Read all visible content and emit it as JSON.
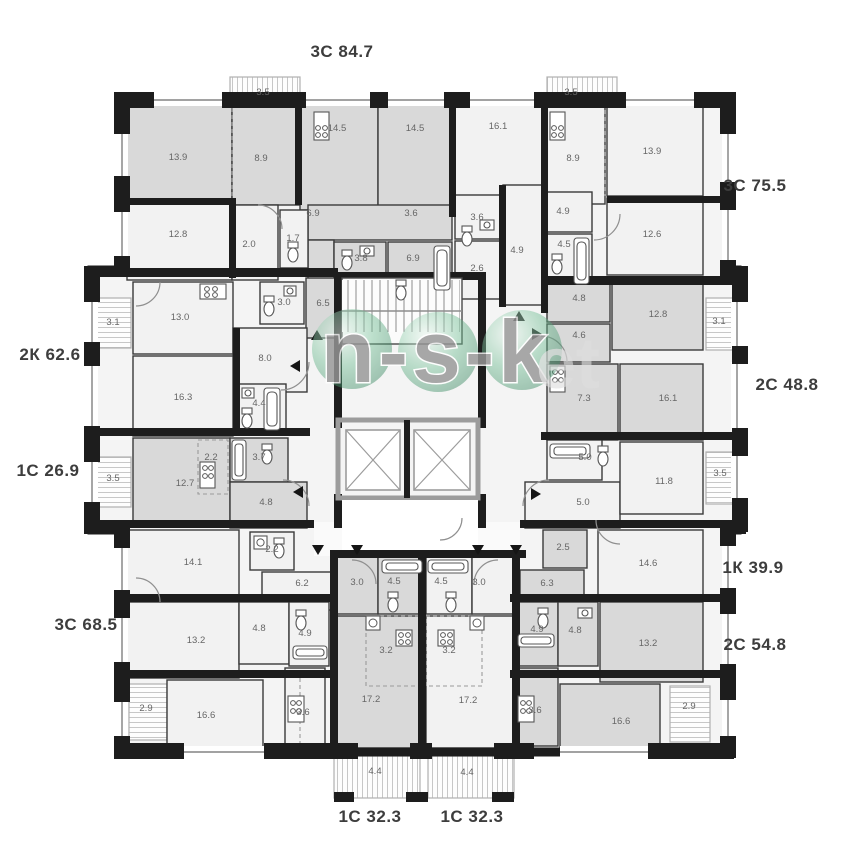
{
  "watermark": {
    "text": "n-s-k",
    "suffix": "et"
  },
  "apartment_labels": [
    {
      "label": "3С 84.7"
    },
    {
      "label": "3С 75.5"
    },
    {
      "label": "2С 48.8"
    },
    {
      "label": "1К 39.9"
    },
    {
      "label": "2С 54.8"
    },
    {
      "label": "1С 32.3"
    },
    {
      "label": "1С 32.3"
    },
    {
      "label": "3С 68.5"
    },
    {
      "label": "1С 26.9"
    },
    {
      "label": "2К 62.6"
    }
  ],
  "rooms": [
    {
      "a": "3.5"
    },
    {
      "a": "14.5"
    },
    {
      "a": "14.5"
    },
    {
      "a": "16.1"
    },
    {
      "a": "3.5"
    },
    {
      "a": "13.9"
    },
    {
      "a": "8.9"
    },
    {
      "a": "8.9"
    },
    {
      "a": "13.9"
    },
    {
      "a": "12.8"
    },
    {
      "a": "2.0"
    },
    {
      "a": "1.7"
    },
    {
      "a": "6.9"
    },
    {
      "a": "3.6"
    },
    {
      "a": "3.8"
    },
    {
      "a": "6.9"
    },
    {
      "a": "3.6"
    },
    {
      "a": "4.9"
    },
    {
      "a": "2.6"
    },
    {
      "a": "4.9"
    },
    {
      "a": "4.5"
    },
    {
      "a": "12.6"
    },
    {
      "a": "3.1"
    },
    {
      "a": "13.0"
    },
    {
      "a": "3.0"
    },
    {
      "a": "6.5"
    },
    {
      "a": "8.0"
    },
    {
      "a": "16.3"
    },
    {
      "a": "4.4"
    },
    {
      "a": "4.8"
    },
    {
      "a": "12.8"
    },
    {
      "a": "3.1"
    },
    {
      "a": "4.6"
    },
    {
      "a": "7.3"
    },
    {
      "a": "16.1"
    },
    {
      "a": "2.2"
    },
    {
      "a": "3.7"
    },
    {
      "a": "3.5"
    },
    {
      "a": "12.7"
    },
    {
      "a": "4.8"
    },
    {
      "a": "5.0"
    },
    {
      "a": "5.0"
    },
    {
      "a": "11.8"
    },
    {
      "a": "3.5"
    },
    {
      "a": "14.1"
    },
    {
      "a": "2.2"
    },
    {
      "a": "6.2"
    },
    {
      "a": "2.5"
    },
    {
      "a": "6.3"
    },
    {
      "a": "14.6"
    },
    {
      "a": "3.0"
    },
    {
      "a": "4.5"
    },
    {
      "a": "4.5"
    },
    {
      "a": "3.0"
    },
    {
      "a": "13.2"
    },
    {
      "a": "4.8"
    },
    {
      "a": "4.9"
    },
    {
      "a": "4.9"
    },
    {
      "a": "4.8"
    },
    {
      "a": "13.2"
    },
    {
      "a": "3.2"
    },
    {
      "a": "3.2"
    },
    {
      "a": "2.9"
    },
    {
      "a": "16.6"
    },
    {
      "a": "3.6"
    },
    {
      "a": "17.2"
    },
    {
      "a": "17.2"
    },
    {
      "a": "3.6"
    },
    {
      "a": "16.6"
    },
    {
      "a": "2.9"
    },
    {
      "a": "4.4"
    },
    {
      "a": "4.4"
    }
  ],
  "colors": {
    "wall": "#1d1d1d",
    "room_gray": "#d9d9d9",
    "room_light": "#f2f2f2",
    "balcony_hatch": "#c7c7c7",
    "core_wall": "#9c9c9c",
    "watermark_green": "#4caf7d",
    "room_label": "#666666",
    "apartment_label": "#3d3d3d"
  }
}
